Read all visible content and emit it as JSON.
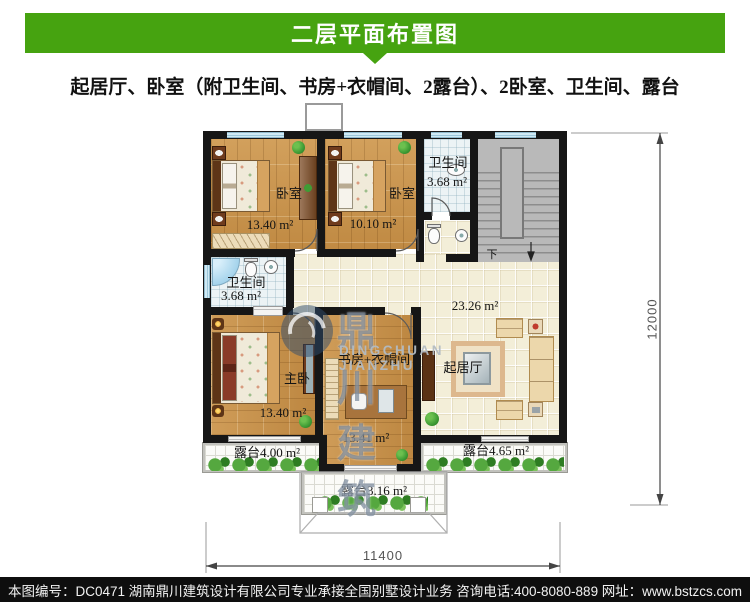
{
  "header": {
    "title": "二层平面布置图",
    "subtitle": "起居厅、卧室（附卫生间、书房+衣帽间、2露台）、2卧室、卫生间、露台"
  },
  "watermark": {
    "logo_cn": "鼎川建筑",
    "logo_en": "DINGCHUAN JIANZHU"
  },
  "plan": {
    "rooms": {
      "bedroom1": {
        "name": "卧室",
        "area": "13.40 m²"
      },
      "bedroom2": {
        "name": "卧室",
        "area": "10.10 m²"
      },
      "bath_top": {
        "name": "卫生间",
        "area": "3.68 m²"
      },
      "bath_left": {
        "name": "卫生间",
        "area": "3.68 m²"
      },
      "hall": {
        "area": "23.26 m²"
      },
      "master": {
        "name": "主卧",
        "area": "13.40 m²"
      },
      "study": {
        "name": "书房+衣帽间",
        "area": "13.41 m²"
      },
      "living": {
        "name": "起居厅"
      },
      "terrace_left": {
        "name": "露台4.00 m²"
      },
      "terrace_right": {
        "name": "露台4.65 m²"
      },
      "terrace_bottom": {
        "name": "露台3.16 m²"
      }
    },
    "stair_down": "下",
    "dim_width": "11400",
    "dim_height": "12000"
  },
  "footer": {
    "drawing_no": "本图编号：DC0471",
    "company": "湖南鼎川建筑设计有限公司专业承接全国别墅设计业务",
    "phone": "咨询电话:400-8080-889",
    "website": "网址：www.bstzcs.com"
  },
  "colors": {
    "header_green": "#46a310",
    "footer_bg": "#0e0e0e",
    "wall": "#161616",
    "tile": "#f3eed8",
    "bath": "#ecf3f5",
    "stair": "#b9b9b9",
    "window": "#cfe9f4",
    "plant": "#3f9c35"
  }
}
